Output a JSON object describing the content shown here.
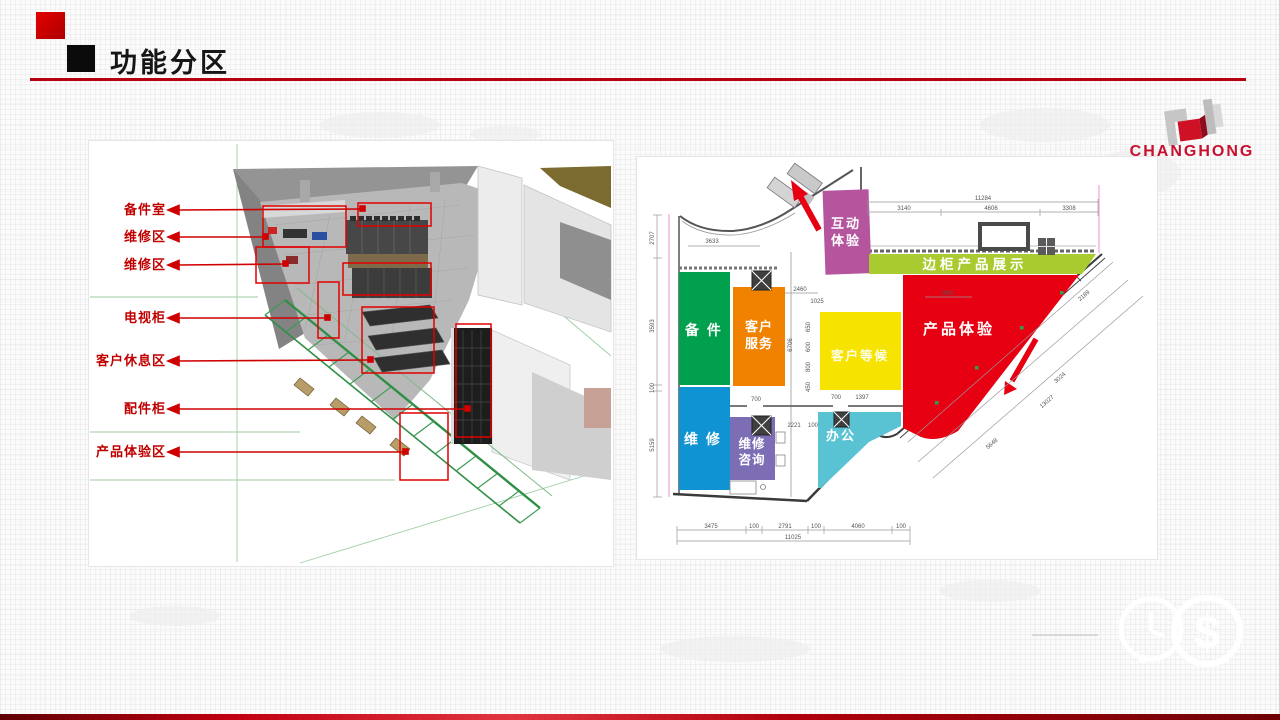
{
  "slide": {
    "title": "功能分区",
    "accent": "#c00000",
    "brand": "CHANGHONG"
  },
  "render": {
    "labels": [
      {
        "text": "备件室"
      },
      {
        "text": "维修区"
      },
      {
        "text": "维修区"
      },
      {
        "text": "电视柜"
      },
      {
        "text": "客户休息区"
      },
      {
        "text": "配件柜"
      },
      {
        "text": "产品体验区"
      }
    ]
  },
  "floorplan": {
    "zones": {
      "hudong": {
        "l1": "互动",
        "l2": "体验",
        "color": "#b4559e"
      },
      "biangui": {
        "l1": "边柜产品展示",
        "color": "#a9cb2f"
      },
      "beijian": {
        "l1": "备 件",
        "color": "#00a04e"
      },
      "kehufuwu": {
        "l1": "客户",
        "l2": "服务",
        "color": "#f08200"
      },
      "kehudenghou": {
        "l1": "客户等候",
        "color": "#f6e400"
      },
      "chanpin": {
        "l1": "产品体验",
        "color": "#e60012"
      },
      "weixiu": {
        "l1": "维 修",
        "color": "#0f93d2"
      },
      "weixiuzixun": {
        "l1": "维修",
        "l2": "咨询",
        "color": "#7d6db4"
      },
      "bangong": {
        "l1": "办公",
        "color": "#59c3d3"
      }
    },
    "dims": {
      "top_total": "11284",
      "top": [
        "3140",
        "4606",
        "3308"
      ],
      "left": [
        "2707",
        "3593",
        "100",
        "5159"
      ],
      "right": [
        "2189",
        "3024",
        "13027",
        "5648"
      ],
      "bottom": [
        "3475",
        "100",
        "2791",
        "100",
        "4060",
        "100"
      ],
      "bottom_total": "11025",
      "inner": [
        "3633",
        "2460",
        "2900",
        "1025",
        "6706",
        "700",
        "700",
        "1397",
        "2221",
        "100",
        "650",
        "600",
        "800",
        "450"
      ]
    }
  },
  "watermark": {
    "dollar": "$"
  }
}
